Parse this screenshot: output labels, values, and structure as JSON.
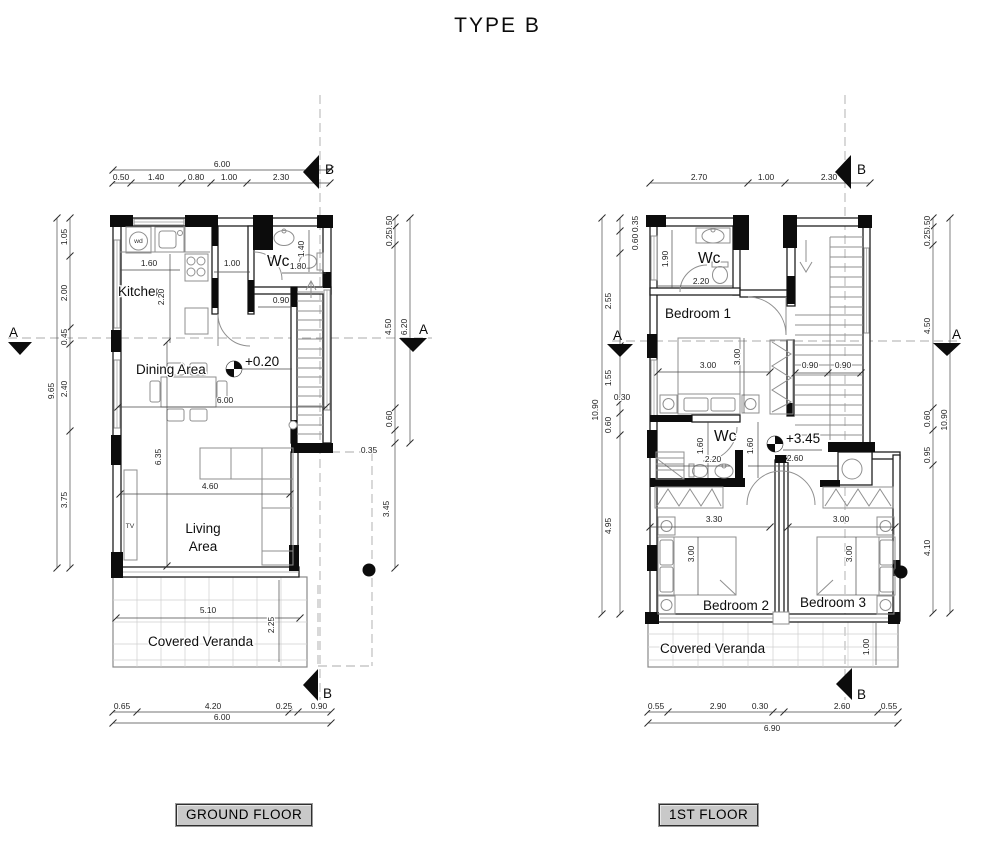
{
  "title": "TYPE B",
  "section_markers": {
    "a": "A",
    "b": "B"
  },
  "floors": {
    "ground": {
      "name_label": "GROUND FLOOR",
      "level": "+0.20",
      "rooms": {
        "kitchen": "Kitchen",
        "dining": "Dining Area",
        "living_line1": "Living",
        "living_line2": "Area",
        "wc": "Wc",
        "veranda": "Covered Veranda"
      },
      "furniture": {
        "washer": "wd",
        "tv": "TV"
      },
      "dims": {
        "top_total": "6.00",
        "top": [
          "0.50",
          "1.40",
          "0.80",
          "1.00",
          "2.30"
        ],
        "left_total": "9.65",
        "left": [
          "1.05",
          "2.00",
          "0.45",
          "2.40",
          "3.75"
        ],
        "right": [
          "0.50",
          "0.25",
          "4.50",
          "6.20",
          "0.60",
          "0.35",
          "3.45"
        ],
        "bottom": [
          "0.65",
          "4.20",
          "0.25",
          "0.90"
        ],
        "bottom_total": "6.00",
        "kitchen_w": "1.60",
        "kitchen_d": "2.20",
        "hall_w": "1.00",
        "wc_d": "1.40",
        "wc_w": "1.80",
        "stair_w": "0.90",
        "dining_w": "6.00",
        "living_d": "6.35",
        "living_w": "4.60",
        "veranda_w": "5.10",
        "veranda_d": "2.25"
      }
    },
    "first": {
      "name_label": "1ST FLOOR",
      "level": "+3.45",
      "rooms": {
        "wc_top": "Wc",
        "bedroom1": "Bedroom 1",
        "wc_mid": "Wc",
        "bedroom2": "Bedroom 2",
        "bedroom3": "Bedroom 3",
        "veranda": "Covered Veranda"
      },
      "dims": {
        "top": [
          "2.70",
          "1.00",
          "2.30"
        ],
        "left_total": "10.90",
        "left": [
          "0.35",
          "0.60",
          "2.55",
          "1.55",
          "0.30",
          "0.60",
          "4.95"
        ],
        "right": [
          "0.50",
          "0.25",
          "4.50",
          "0.60",
          "0.95",
          "4.10"
        ],
        "right_total": "10.90",
        "bottom": [
          "0.55",
          "2.90",
          "0.30",
          "2.60",
          "0.55"
        ],
        "bottom_total": "6.90",
        "wc_top_d": "1.90",
        "wc_top_w": "2.20",
        "bed1_w": "3.00",
        "bed1_d": "3.00",
        "stair_left": "0.90",
        "stair_right": "0.90",
        "wc_mid_d1": "1.60",
        "wc_mid_w": "2.20",
        "wc_mid_d2": "1.60",
        "corridor_w": "2.60",
        "bed2_w": "3.30",
        "bed2_d": "3.00",
        "bed3_w": "3.00",
        "bed3_d": "3.00",
        "veranda_d": "1.00"
      }
    }
  }
}
